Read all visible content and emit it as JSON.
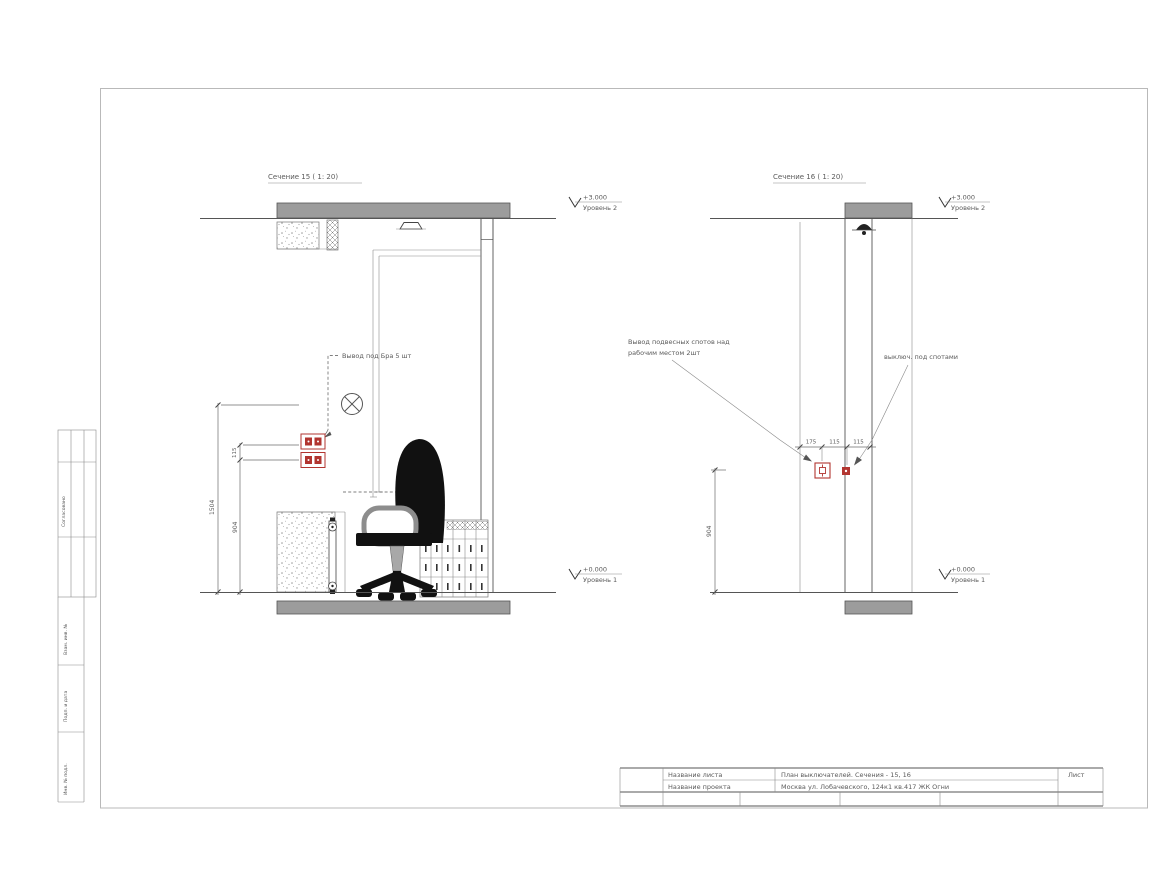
{
  "colors": {
    "accent_red": "#b23530",
    "slab_gray": "#9c9c9c",
    "line_dark": "#4f4f4f",
    "text_gray": "#5a5a5a"
  },
  "sections": {
    "left": {
      "title": "Сечение 15 ( 1: 20)",
      "annotation": "Вывод под Бра 5 шт",
      "dim_outer": "1504",
      "dim_gap": "115",
      "dim_socket": "904",
      "level_top_value": "+3.000",
      "level_top_label": "Уровень 2",
      "level_bottom_value": "+0.000",
      "level_bottom_label": "Уровень 1"
    },
    "right": {
      "title": "Сечение 16 ( 1: 20)",
      "annotation_line1": "Вывод подвесных спотов над",
      "annotation_line2": "рабочим местом 2шт",
      "annotation_right": "выключ. под спотами",
      "dim_chain": [
        "175",
        "115",
        "115"
      ],
      "dim_height": "904",
      "level_top_value": "+3.000",
      "level_top_label": "Уровень 2",
      "level_bottom_value": "+0.000",
      "level_bottom_label": "Уровень 1"
    }
  },
  "side_stamp": {
    "approved": "Согласовано",
    "labels": [
      "Взам. инв. №",
      "Подп. и дата",
      "Инв. № подл."
    ]
  },
  "title_block": {
    "sheet_name_label": "Название листа",
    "sheet_name_value": "План выключателей. Сечения - 15, 16",
    "project_label": "Название проекта",
    "project_value": "Москва ул. Лобачевского, 124к1 кв.417 ЖК Огни",
    "list_label": "Лист"
  }
}
